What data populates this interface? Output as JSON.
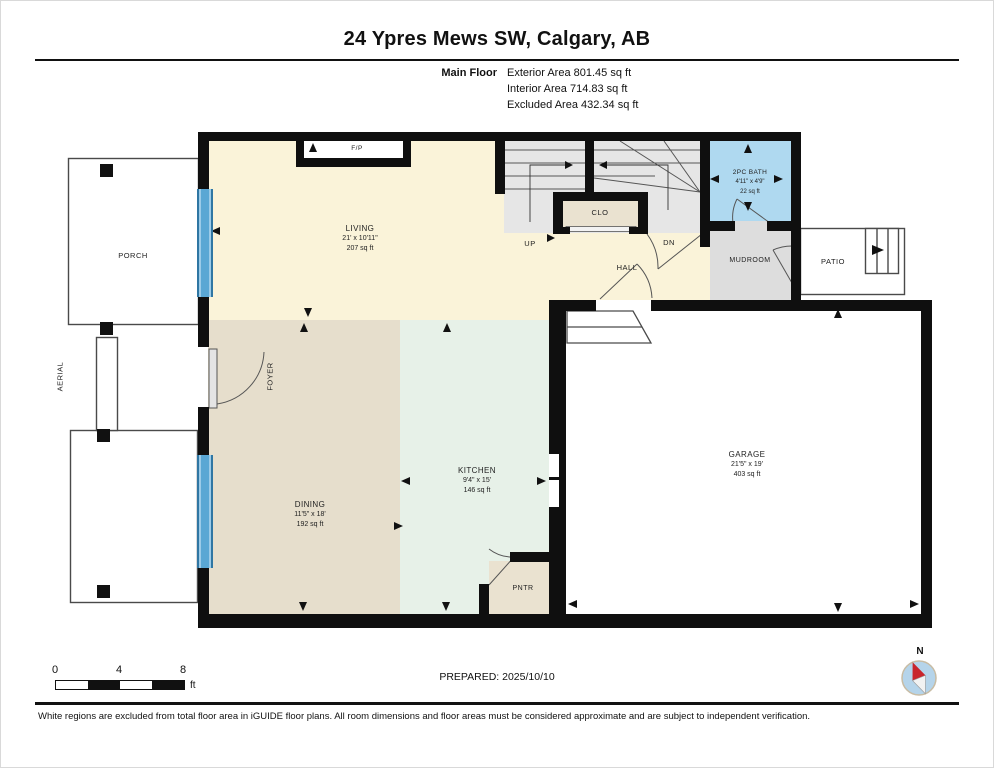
{
  "header": {
    "title": "24 Ypres Mews SW, Calgary, AB",
    "floor_label": "Main Floor",
    "area_lines": [
      "Exterior Area 801.45 sq ft",
      "Interior Area 714.83 sq ft",
      "Excluded Area 432.34 sq ft"
    ]
  },
  "rooms": {
    "living": {
      "name": "LIVING",
      "dims": "21' x 10'11\"",
      "area": "207 sq ft"
    },
    "dining": {
      "name": "DINING",
      "dims": "11'5\" x 18'",
      "area": "192 sq ft"
    },
    "kitchen": {
      "name": "KITCHEN",
      "dims": "9'4\" x 15'",
      "area": "146 sq ft"
    },
    "garage": {
      "name": "GARAGE",
      "dims": "21'5\" x 19'",
      "area": "403 sq ft"
    },
    "bath": {
      "name": "2PC BATH",
      "dims": "4'11\" x 4'9\"",
      "area": "22 sq ft"
    }
  },
  "labels": {
    "porch": "PORCH",
    "aerial": "AERIAL",
    "foyer": "FOYER",
    "hall": "HALL",
    "clo": "CLO",
    "mudroom": "MUDROOM",
    "patio": "PATIO",
    "pntr": "PNTR",
    "fireplace": "F/P",
    "up": "UP",
    "dn": "DN"
  },
  "footer": {
    "scale_ticks": [
      "0",
      "4",
      "8"
    ],
    "scale_unit": "ft",
    "prepared": "PREPARED: 2025/10/10",
    "compass_north": "N",
    "disclaimer": "White regions are excluded from total floor area in iGUIDE floor plans. All room dimensions and floor areas must be considered approximate and are subject to independent verification."
  },
  "colors": {
    "living": "#FAF3D9",
    "dining": "#E6DECC",
    "kitchen": "#E7F1E8",
    "bath": "#AFD9F0",
    "mudroom": "#DDDDDD",
    "stairs": "#E6E6E6",
    "closet": "#EAE2D0",
    "window": "#5AA7D4",
    "wall": "#0F0F0F",
    "compass_needle": "#C9252C"
  }
}
